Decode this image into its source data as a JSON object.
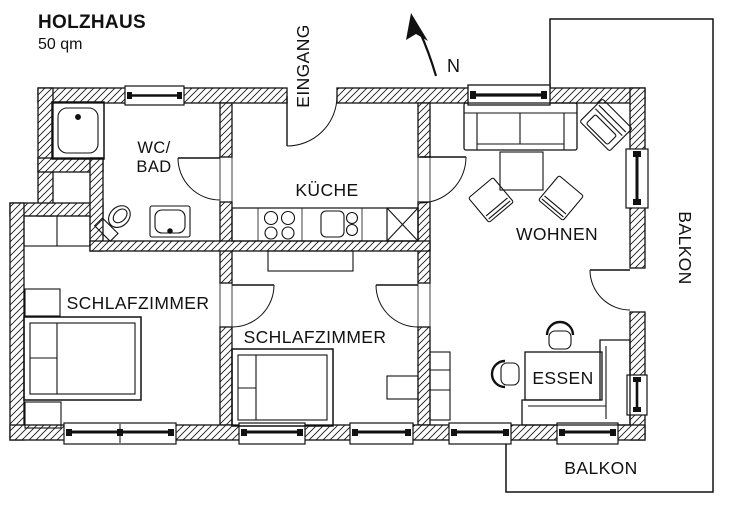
{
  "title": "HOLZHAUS",
  "subtitle": "50 qm",
  "compass": {
    "north_label": "N"
  },
  "labels": {
    "entrance": "EINGANG",
    "wc_bad_line1": "WC/",
    "wc_bad_line2": "BAD",
    "kueche": "KÜCHE",
    "wohnen": "WOHNEN",
    "schlafzimmer_left": "SCHLAFZIMMER",
    "schlafzimmer_middle": "SCHLAFZIMMER",
    "essen": "ESSEN",
    "balkon_right": "BALKON",
    "balkon_bottom": "BALKON"
  },
  "colors": {
    "line": "#111111",
    "background": "#ffffff"
  }
}
